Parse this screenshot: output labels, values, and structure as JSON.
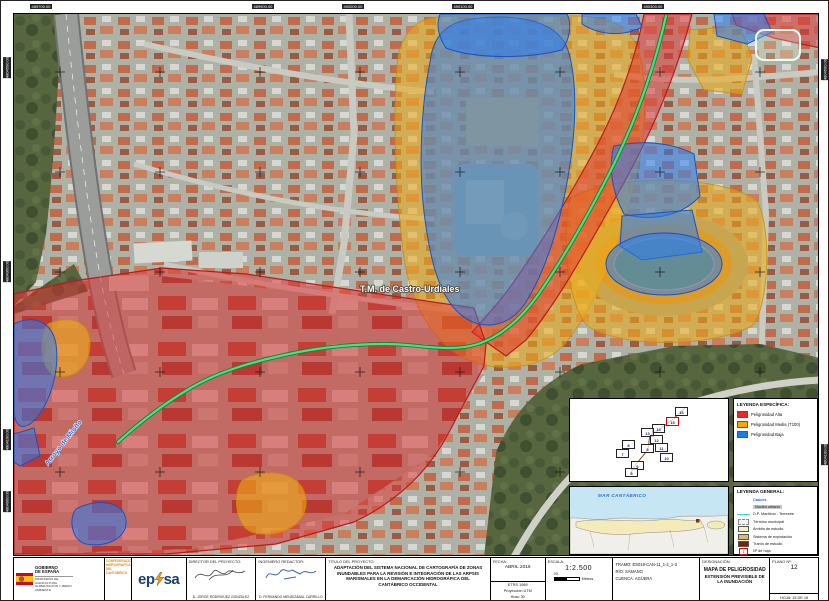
{
  "colors": {
    "hazard_high": "#e03434",
    "hazard_medium": "#f5a800",
    "hazard_low": "#1f78f0",
    "river_line": "#49e37c",
    "confederation_orange": "#e8890a",
    "eptisa_blue": "#1b3f77"
  },
  "map": {
    "municipality_label": "T.M. de Castro-Urdiales",
    "stream_label": "Arroyo de Mioño",
    "coordinates": {
      "top": [
        {
          "value": "489700.00",
          "x": 40
        },
        {
          "value": "489900.00",
          "x": 262
        },
        {
          "value": "490000.00",
          "x": 352
        },
        {
          "value": "490100.00",
          "x": 462
        },
        {
          "value": "490300.00",
          "x": 652
        }
      ],
      "left": [
        {
          "value": "4804500.00",
          "y": 68
        },
        {
          "value": "4804300.00",
          "y": 272
        },
        {
          "value": "4804100.00",
          "y": 440
        },
        {
          "value": "4804000.00",
          "y": 502
        }
      ],
      "right": [
        {
          "value": "4804500.00",
          "y": 70
        },
        {
          "value": "4804100.00",
          "y": 455
        }
      ]
    }
  },
  "sheet_index": {
    "sheets": [
      {
        "num": "16",
        "x": 105,
        "y": 8,
        "current": false
      },
      {
        "num": "15",
        "x": 96,
        "y": 18,
        "current": true
      },
      {
        "num": "14",
        "x": 82,
        "y": 25,
        "current": false
      },
      {
        "num": "13",
        "x": 71,
        "y": 29,
        "current": false
      },
      {
        "num": "12",
        "x": 80,
        "y": 36,
        "current": false
      },
      {
        "num": "11",
        "x": 85,
        "y": 44,
        "current": false
      },
      {
        "num": "10",
        "x": 90,
        "y": 54,
        "current": false
      },
      {
        "num": "9",
        "x": 71,
        "y": 45,
        "current": false
      },
      {
        "num": "8",
        "x": 52,
        "y": 41,
        "current": false
      },
      {
        "num": "7",
        "x": 46,
        "y": 50,
        "current": false
      },
      {
        "num": "6",
        "x": 61,
        "y": 62,
        "current": false
      },
      {
        "num": "5",
        "x": 55,
        "y": 69,
        "current": false
      }
    ]
  },
  "legend_specific": {
    "title": "LEYENDA ESPECÍFICA:",
    "items": [
      {
        "label": "Peligrosidad Alta",
        "color": "#e8282b"
      },
      {
        "label": "Peligrosidad Media (T100)",
        "color": "#f5a800"
      },
      {
        "label": "Peligrosidad Baja",
        "color": "#1f78f0"
      }
    ]
  },
  "legend_general": {
    "title": "LEYENDA GENERAL:",
    "items": [
      {
        "label": "Cauces",
        "type": "text-blue"
      },
      {
        "label": "Núcleo urbano",
        "type": "text-chip"
      },
      {
        "label": "D.P. Marítimo - Terrestre",
        "type": "line-cyan",
        "color": "#3fd4d4"
      },
      {
        "label": "Término municipal",
        "type": "dashed-box"
      },
      {
        "label": "Ámbito de estudio",
        "type": "swatch",
        "color": "#f5efc4"
      },
      {
        "label": "Sistema de explotación",
        "type": "swatch",
        "color": "#e8b468"
      },
      {
        "label": "Tramo de estudio",
        "type": "swatch",
        "color": "#6e2a00"
      },
      {
        "label": "Nº de hoja",
        "type": "red-outline-box",
        "number": "1"
      }
    ]
  },
  "region_inset": {
    "sea_label": "MAR CANTÁBRICO"
  },
  "title_block": {
    "gov_logo": {
      "line1": "GOBIERNO",
      "line2": "DE ESPAÑA",
      "ministry": "MINISTERIO DE AGRICULTURA, ALIMENTACIÓN Y MEDIO AMBIENTE"
    },
    "confederation": "CONFEDERACIÓN HIDROGRÁFICA DEL CANTÁBRICO",
    "company_logo_left": "ep",
    "company_logo_right": "sa",
    "director": {
      "label": "DIRECTOR DEL PROYECTO:",
      "name": "D. JORGE RODRÍGUEZ GONZÁLEZ"
    },
    "engineer": {
      "label": "INGENIERO REDACTOR:",
      "name": "D. FERNANDO MENDIZÁBAL CARRILLO"
    },
    "project": {
      "label": "TÍTULO DEL PROYECTO:",
      "text": "ADAPTACIÓN DEL SISTEMA NACIONAL DE CARTOGRAFÍA DE ZONAS INUNDABLES PARA LA REVISIÓN E INTEGRACIÓN DE LAS ARPSIS MARISMALES EN LA DEMARCACIÓN HIDROGRÁFICA DEL CANTÁBRICO OCCIDENTAL"
    },
    "date": {
      "label": "FECHA:",
      "value": "ABRIL 2016"
    },
    "datum_line1": "ETRS 1989",
    "datum_line2": "Proyección UTM",
    "datum_line3": "Huso 30",
    "scale": {
      "label": "ESCALA:",
      "value": "1:2.500",
      "bar_value": "20",
      "bar_unit": "Metros"
    },
    "tramo": "TRAMO: ES018-CAN-11_1-2_1-3",
    "rio": "RÍO: SÁMANO",
    "cuenca": "CUENCA: AGÜERA",
    "designation": {
      "label": "DESIGNACIÓN:",
      "line1": "MAPA DE PELIGROSIDAD",
      "line2": "EXTENSIÓN PREVISIBLE DE LA INUNDACIÓN"
    },
    "plano": {
      "label": "PLANO Nº:",
      "value": "12"
    },
    "hoja": "HOJA: 15 DE 16"
  }
}
